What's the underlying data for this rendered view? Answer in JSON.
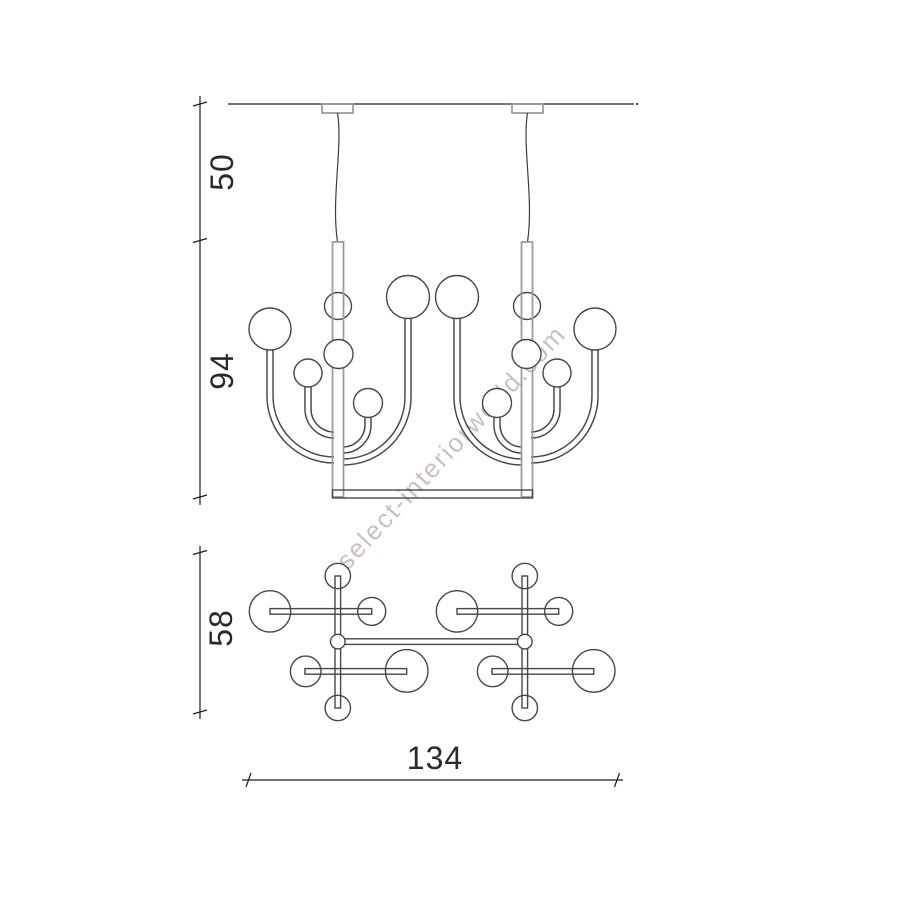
{
  "watermark": {
    "text": "select-interiorworld.com",
    "color": "#c6b9bd"
  },
  "dimensions": {
    "suspension_height": "50",
    "body_height": "94",
    "plan_depth": "58",
    "plan_width": "134"
  },
  "colors": {
    "line": "#474747",
    "tube": "#9c9c9c",
    "dim": "#1c1c1c",
    "wire": "#3d3d3d",
    "background": "#ffffff"
  }
}
